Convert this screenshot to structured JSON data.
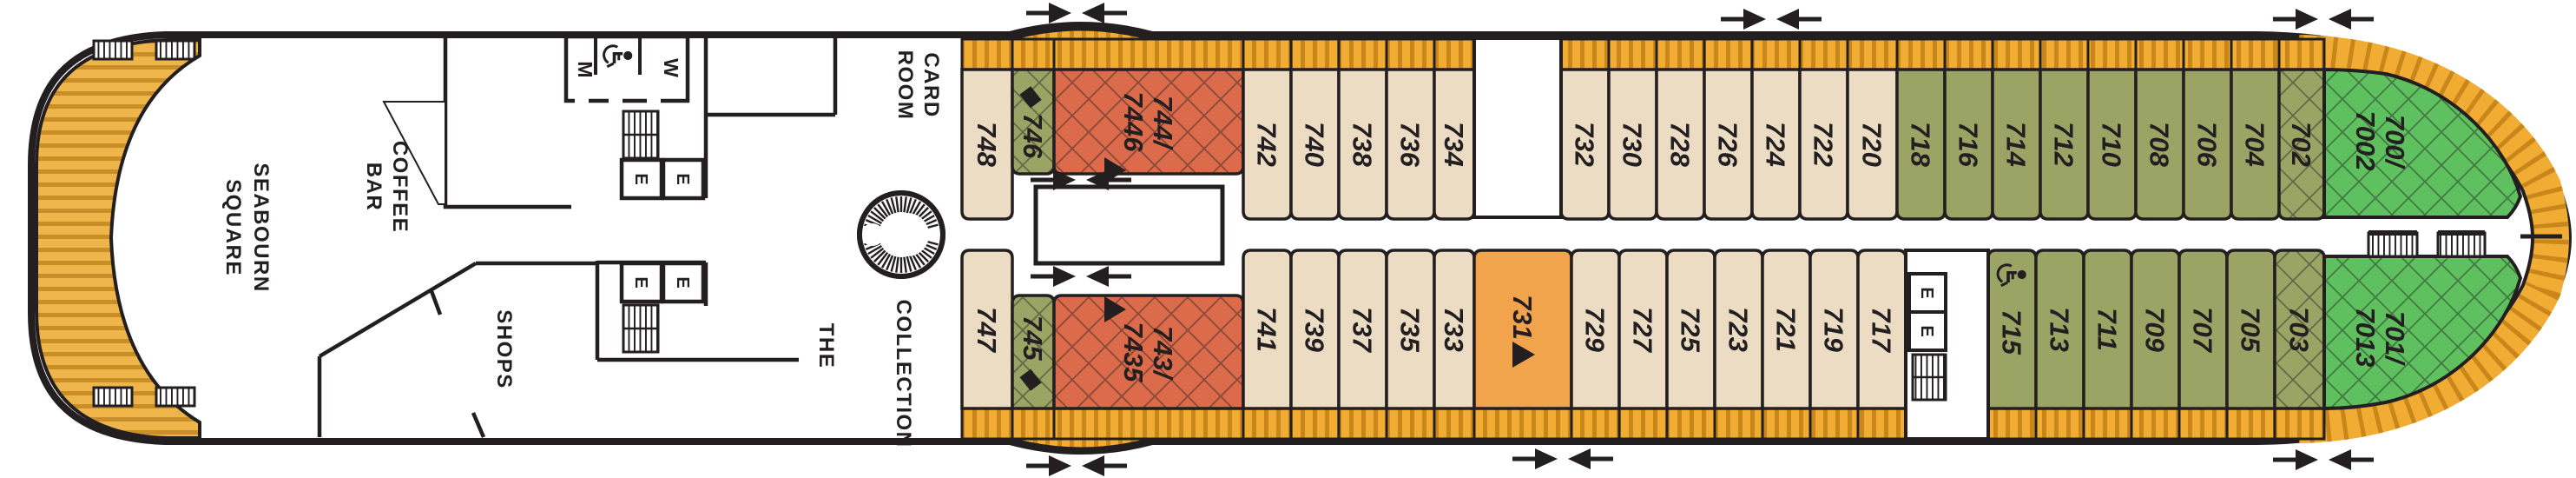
{
  "palette": {
    "outline": "#231f20",
    "cabin_standard": "#EBDCC3",
    "cabin_olive": "#99A465",
    "cabin_suite_red": "#DB6B4B",
    "cabin_signature_orange": "#F2A44C",
    "cabin_premium_green": "#5EC05F",
    "balcony": "#F0AC33",
    "balcony_stripe": "#C8861B",
    "wood_deck": "#EDB54A",
    "wood_stripe": "#C98E27"
  },
  "labels": {
    "elevator": "E",
    "restroom_men": "M",
    "restroom_women": "W"
  },
  "rooms": {
    "seabourn_square": {
      "line1": "SEABOURN",
      "line2": "SQUARE"
    },
    "coffee_bar": {
      "line1": "COFFEE",
      "line2": "BAR"
    },
    "shops": "SHOPS",
    "card_room": {
      "line1": "CARD",
      "line2": "ROOM"
    },
    "the_collection": {
      "line1": "THE",
      "line2": "COLLECTION"
    }
  },
  "icons": {
    "diamond": "diamond-icon",
    "triangle": "triangle-icon",
    "wheelchair": "wheelchair-accessible-icon",
    "arrows": "section-divider-arrows-icon"
  },
  "cabins": {
    "top": [
      {
        "n": "748",
        "cat": "beige"
      },
      {
        "n": "746",
        "cat": "olive_hatch",
        "icon": "diamond_before"
      },
      {
        "n": "744/7446",
        "cat": "red_hatch",
        "icon": "triangle"
      },
      {
        "n": "742",
        "cat": "beige"
      },
      {
        "n": "740",
        "cat": "beige"
      },
      {
        "n": "738",
        "cat": "beige"
      },
      {
        "n": "736",
        "cat": "beige"
      },
      {
        "n": "734",
        "cat": "beige"
      },
      {
        "n": "732",
        "cat": "beige"
      },
      {
        "n": "730",
        "cat": "beige"
      },
      {
        "n": "728",
        "cat": "beige"
      },
      {
        "n": "726",
        "cat": "beige"
      },
      {
        "n": "724",
        "cat": "beige"
      },
      {
        "n": "722",
        "cat": "beige"
      },
      {
        "n": "720",
        "cat": "beige"
      },
      {
        "n": "718",
        "cat": "olive"
      },
      {
        "n": "716",
        "cat": "olive"
      },
      {
        "n": "714",
        "cat": "olive"
      },
      {
        "n": "712",
        "cat": "olive"
      },
      {
        "n": "710",
        "cat": "olive"
      },
      {
        "n": "708",
        "cat": "olive"
      },
      {
        "n": "706",
        "cat": "olive"
      },
      {
        "n": "704",
        "cat": "olive"
      },
      {
        "n": "702",
        "cat": "olive_hatch"
      }
    ],
    "bottom": [
      {
        "n": "747",
        "cat": "beige"
      },
      {
        "n": "745",
        "cat": "olive_hatch",
        "icon": "diamond_after"
      },
      {
        "n": "743/7435",
        "cat": "red_hatch",
        "icon": "triangle"
      },
      {
        "n": "741",
        "cat": "beige"
      },
      {
        "n": "739",
        "cat": "beige"
      },
      {
        "n": "737",
        "cat": "beige"
      },
      {
        "n": "735",
        "cat": "beige"
      },
      {
        "n": "733",
        "cat": "beige"
      },
      {
        "n": "731",
        "cat": "orange",
        "icon": "triangle"
      },
      {
        "n": "729",
        "cat": "beige"
      },
      {
        "n": "727",
        "cat": "beige"
      },
      {
        "n": "725",
        "cat": "beige"
      },
      {
        "n": "723",
        "cat": "beige"
      },
      {
        "n": "721",
        "cat": "beige"
      },
      {
        "n": "719",
        "cat": "beige"
      },
      {
        "n": "717",
        "cat": "beige"
      },
      {
        "n": "715",
        "cat": "olive",
        "icon": "wheelchair"
      },
      {
        "n": "713",
        "cat": "olive"
      },
      {
        "n": "711",
        "cat": "olive"
      },
      {
        "n": "709",
        "cat": "olive"
      },
      {
        "n": "707",
        "cat": "olive"
      },
      {
        "n": "705",
        "cat": "olive"
      },
      {
        "n": "703",
        "cat": "olive_hatch"
      }
    ],
    "wedge_top": {
      "n": "700/7002",
      "line1": "700/",
      "line2": "7002"
    },
    "wedge_bottom": {
      "n": "701/7013",
      "line1": "701/",
      "line2": "7013"
    }
  }
}
